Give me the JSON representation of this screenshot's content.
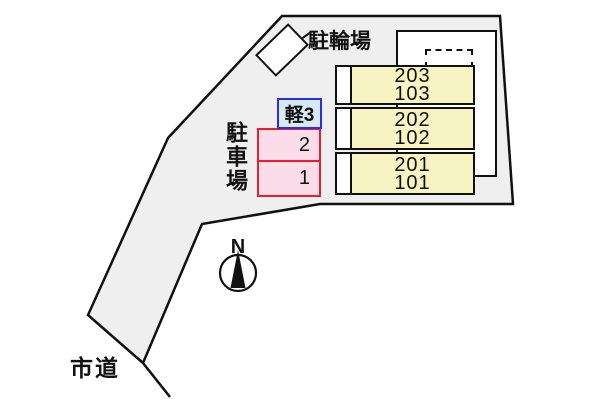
{
  "plan": {
    "bicycle_area_label": "駐輪場",
    "parking_area_label": "駐車場",
    "road_label": "市道",
    "compass": {
      "north_label": "N"
    },
    "kei_space_label": "軽3",
    "parking_spaces": [
      {
        "label": "2"
      },
      {
        "label": "1"
      }
    ],
    "rooms": [
      {
        "upper": "203",
        "lower": "103"
      },
      {
        "upper": "202",
        "lower": "102"
      },
      {
        "upper": "201",
        "lower": "101"
      }
    ],
    "colors": {
      "site_fill": "#efefef",
      "outline": "#111111",
      "room_fill": "#f8f3c3",
      "kei_fill": "#d9eaf7",
      "kei_border": "#2433dd",
      "space_fill": "#fbdde9",
      "space_border": "#ee1c2c"
    }
  }
}
